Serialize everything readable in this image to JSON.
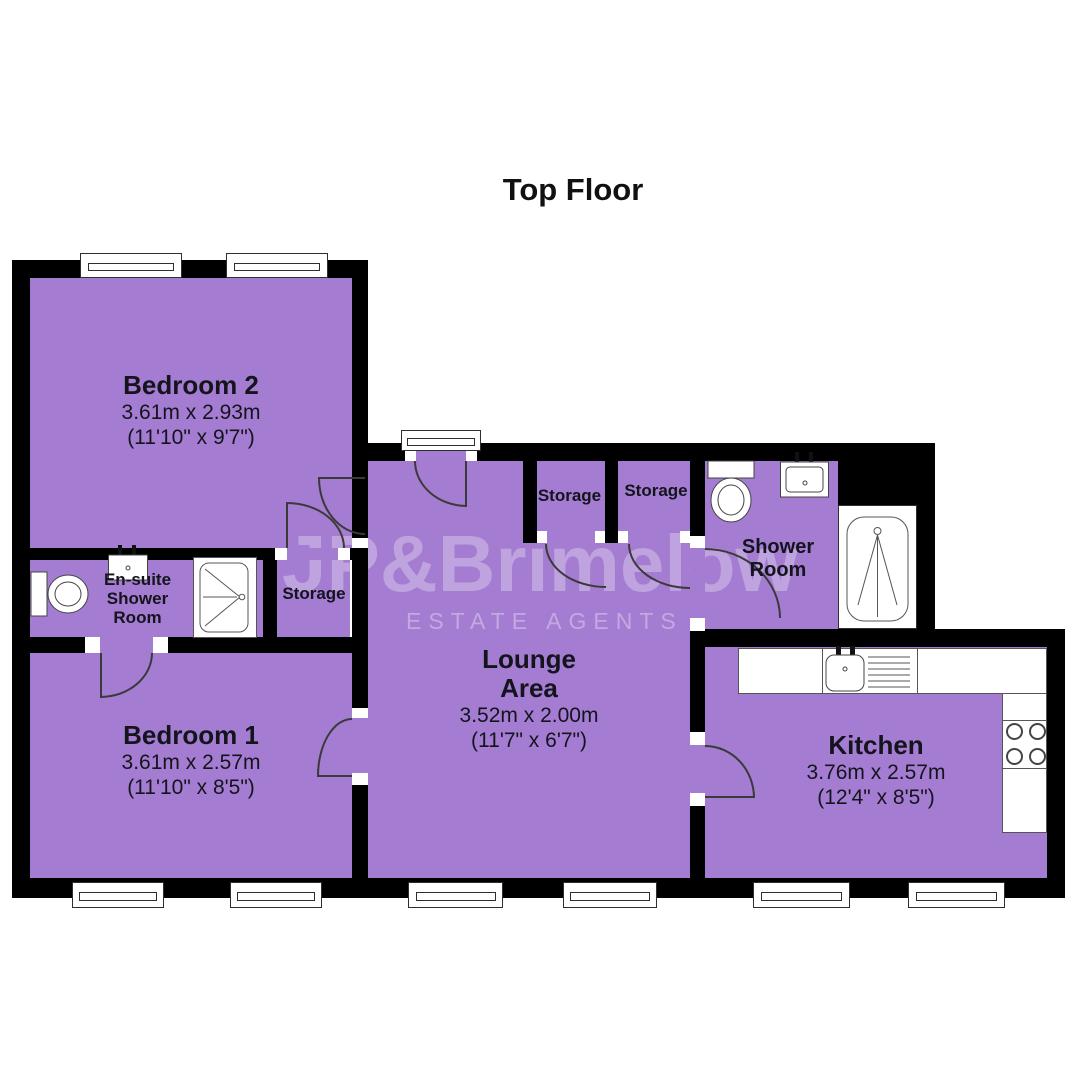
{
  "title": "Top Floor",
  "watermark": {
    "brand": "JP&Brimelow",
    "tagline": "ESTATE AGENTS"
  },
  "rooms": {
    "bedroom2": {
      "name": "Bedroom 2",
      "metric": "3.61m x 2.93m",
      "imperial": "(11'10\" x 9'7\")"
    },
    "bedroom1": {
      "name": "Bedroom 1",
      "metric": "3.61m x 2.57m",
      "imperial": "(11'10\" x 8'5\")"
    },
    "lounge": {
      "name_line1": "Lounge",
      "name_line2": "Area",
      "metric": "3.52m x 2.00m",
      "imperial": "(11'7\" x 6'7\")"
    },
    "kitchen": {
      "name": "Kitchen",
      "metric": "3.76m x 2.57m",
      "imperial": "(12'4\" x 8'5\")"
    },
    "ensuite": {
      "line1": "En-suite",
      "line2": "Shower",
      "line3": "Room"
    },
    "shower_room": {
      "line1": "Shower",
      "line2": "Room"
    },
    "storage_bedroom2": {
      "name": "Storage"
    },
    "storage_hall_left": {
      "name": "Storage"
    },
    "storage_hall_right": {
      "name": "Storage"
    }
  },
  "fixtures": {
    "ensuite": [
      "toilet",
      "sink",
      "shower-tray"
    ],
    "shower_room": [
      "toilet",
      "sink",
      "shower-enclosure"
    ],
    "kitchen": [
      "counter",
      "sink",
      "drainer",
      "hob"
    ]
  },
  "colors": {
    "room_fill": "#A47CD2",
    "wall": "#000000",
    "arc_line": "#3a3a3a",
    "watermark": "rgba(255,255,255,0.30)",
    "watermark2": "rgba(255,255,255,0.34)"
  }
}
